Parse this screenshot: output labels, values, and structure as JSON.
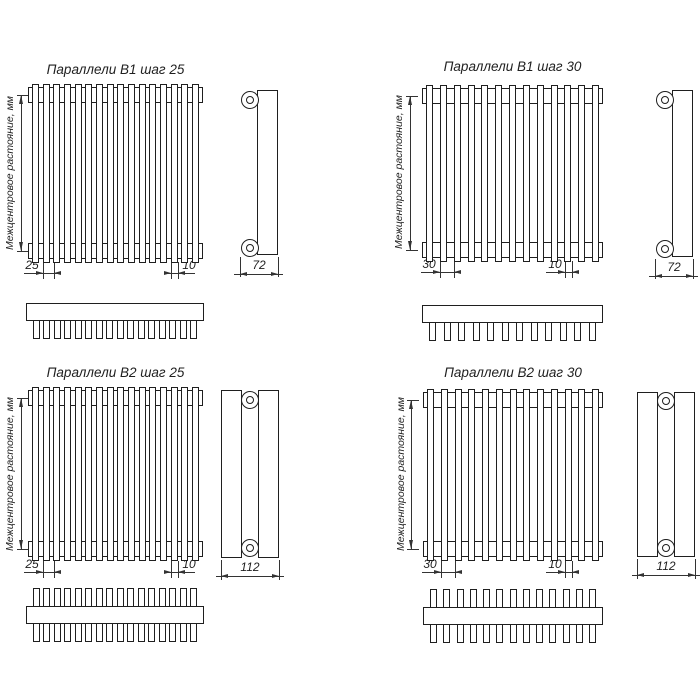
{
  "page": {
    "background": "#ffffff",
    "line_color": "#1f1f1f",
    "center_distance_label": "Межцентровое растояние, мм"
  },
  "quadrants": [
    {
      "title": "Параллели B1 шаг 25",
      "variant": "B1",
      "pitch_mm": "25",
      "tube_width_mm": "10",
      "depth_mm": "72",
      "tube_count": 16,
      "comb_tooth_count": 16
    },
    {
      "title": "Параллели B1 шаг 30",
      "variant": "B1",
      "pitch_mm": "30",
      "tube_width_mm": "10",
      "depth_mm": "72",
      "tube_count": 13,
      "comb_tooth_count": 12
    },
    {
      "title": "Параллели B2 шаг 25",
      "variant": "B2",
      "pitch_mm": "25",
      "tube_width_mm": "10",
      "depth_mm": "112",
      "tube_count": 16,
      "comb_tooth_count": 16
    },
    {
      "title": "Параллели B2 шаг 30",
      "variant": "B2",
      "pitch_mm": "30",
      "tube_width_mm": "10",
      "depth_mm": "112",
      "tube_count": 13,
      "comb_tooth_count": 13
    }
  ]
}
